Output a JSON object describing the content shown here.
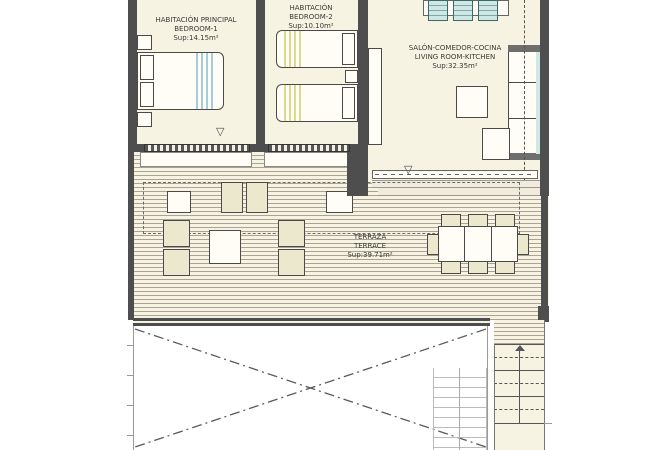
{
  "rooms": {
    "bedroom1": {
      "line1": "HABITACIÓN PRINCIPAL",
      "line2": "BEDROOM-1",
      "area": "Sup:14.15m²"
    },
    "bedroom2": {
      "line1": "HABITACIÓN",
      "line2": "BEDROOM-2",
      "area": "Sup:10.10m²"
    },
    "living": {
      "line1": "SALÓN-COMEDOR-COCINA",
      "line2": "LIVING ROOM-KITCHEN",
      "area": "Sup:32.35m²"
    },
    "terrace": {
      "line1": "TERRAZA",
      "line2": "TERRACE",
      "area": "Sup:39.71m²"
    }
  },
  "icons": {
    "door_swing": "▽"
  },
  "colors": {
    "floor": "#f7f3e2",
    "wall": "#4e4e4e",
    "deck_line": "#aaa393",
    "accent_teal": "#cfe8e5",
    "bed1_stripe_blue": "#a5cfd8",
    "bed2_stripe_yellow": "#ded98e",
    "furniture_tint": "#ece8cd"
  }
}
